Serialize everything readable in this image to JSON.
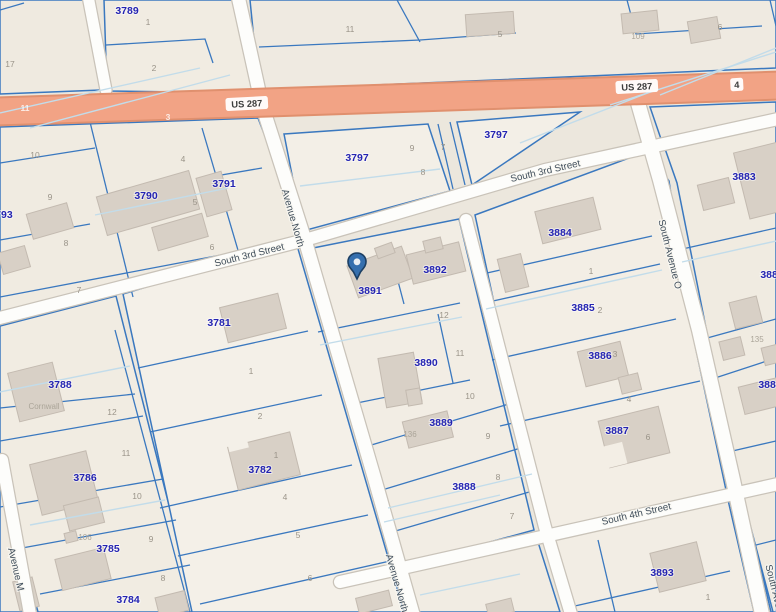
{
  "map": {
    "type": "parcel-gis-map",
    "colors": {
      "background": "#ece7dd",
      "parcel_line_blue": "#3a78bf",
      "parcel_number_navy": "#2424b2",
      "lot_number_gray": "#9a9489",
      "street_label": "#414f5c",
      "highway_fill": "#f2a385",
      "highway_edge": "#e0906e",
      "road_fill": "#fdfdfb",
      "building_fill": "#d8d0c6",
      "pin_fill": "#356fae",
      "pin_outline": "#1c3f63",
      "halflot_line_cyan": "#c2dcea"
    },
    "pin": {
      "name": "selected-location",
      "x": 357,
      "y": 279,
      "parcel": "3891"
    }
  },
  "street_labels": [
    {
      "text": "US 287",
      "x": 247,
      "y": 107,
      "rot": -3,
      "badge": true
    },
    {
      "text": "US 287",
      "x": 637,
      "y": 90,
      "rot": -3,
      "badge": true
    },
    {
      "text": "4",
      "x": 737,
      "y": 88,
      "rot": -3,
      "badge": true
    },
    {
      "text": "South 3rd Street",
      "x": 250,
      "y": 258,
      "rot": -14
    },
    {
      "text": "South 3rd Street",
      "x": 546,
      "y": 174,
      "rot": -13
    },
    {
      "text": "South 4th Street",
      "x": 637,
      "y": 517,
      "rot": -13
    },
    {
      "text": "Avenue North",
      "x": 290,
      "y": 219,
      "rot": 74
    },
    {
      "text": "Avenue North",
      "x": 394,
      "y": 584,
      "rot": 74
    },
    {
      "text": "South Avenue O",
      "x": 667,
      "y": 255,
      "rot": 76
    },
    {
      "text": "South Avenue O",
      "x": 774,
      "y": 600,
      "rot": 76
    },
    {
      "text": "Avenue M",
      "x": 13,
      "y": 570,
      "rot": 77
    }
  ],
  "parcel_labels": [
    {
      "text": "3789",
      "x": 127,
      "y": 14
    },
    {
      "text": "3790",
      "x": 146,
      "y": 199
    },
    {
      "text": "3791",
      "x": 224,
      "y": 187
    },
    {
      "text": "3793",
      "x": 1,
      "y": 218
    },
    {
      "text": "3797",
      "x": 357,
      "y": 161
    },
    {
      "text": "3797",
      "x": 496,
      "y": 138
    },
    {
      "text": "3883",
      "x": 744,
      "y": 180
    },
    {
      "text": "3884",
      "x": 560,
      "y": 236
    },
    {
      "text": "3885",
      "x": 583,
      "y": 311
    },
    {
      "text": "3885",
      "x": 772,
      "y": 278
    },
    {
      "text": "3886",
      "x": 600,
      "y": 359
    },
    {
      "text": "3887",
      "x": 617,
      "y": 434
    },
    {
      "text": "3888",
      "x": 464,
      "y": 490
    },
    {
      "text": "3889",
      "x": 441,
      "y": 426
    },
    {
      "text": "3890",
      "x": 426,
      "y": 366
    },
    {
      "text": "3891",
      "x": 370,
      "y": 294
    },
    {
      "text": "3892",
      "x": 435,
      "y": 273
    },
    {
      "text": "3893",
      "x": 662,
      "y": 576
    },
    {
      "text": "3880",
      "x": 770,
      "y": 388
    },
    {
      "text": "3781",
      "x": 219,
      "y": 326
    },
    {
      "text": "3782",
      "x": 260,
      "y": 473
    },
    {
      "text": "3788",
      "x": 60,
      "y": 388
    },
    {
      "text": "3786",
      "x": 85,
      "y": 481
    },
    {
      "text": "3785",
      "x": 108,
      "y": 552
    },
    {
      "text": "3784",
      "x": 128,
      "y": 603
    }
  ],
  "lot_labels": [
    {
      "text": "17",
      "x": 10,
      "y": 67
    },
    {
      "text": "1",
      "x": 148,
      "y": 25
    },
    {
      "text": "2",
      "x": 154,
      "y": 71
    },
    {
      "text": "11",
      "x": 350,
      "y": 32
    },
    {
      "text": "5",
      "x": 500,
      "y": 37
    },
    {
      "text": "6",
      "x": 720,
      "y": 30
    },
    {
      "text": "10",
      "x": 35,
      "y": 158
    },
    {
      "text": "9",
      "x": 50,
      "y": 200
    },
    {
      "text": "8",
      "x": 66,
      "y": 246
    },
    {
      "text": "7",
      "x": 79,
      "y": 293
    },
    {
      "text": "4",
      "x": 183,
      "y": 162
    },
    {
      "text": "5",
      "x": 195,
      "y": 205
    },
    {
      "text": "6",
      "x": 212,
      "y": 250
    },
    {
      "text": "9",
      "x": 412,
      "y": 151
    },
    {
      "text": "7",
      "x": 443,
      "y": 150
    },
    {
      "text": "8",
      "x": 423,
      "y": 175
    },
    {
      "text": "1",
      "x": 591,
      "y": 274
    },
    {
      "text": "2",
      "x": 600,
      "y": 313
    },
    {
      "text": "3",
      "x": 615,
      "y": 357
    },
    {
      "text": "4",
      "x": 629,
      "y": 402
    },
    {
      "text": "6",
      "x": 648,
      "y": 440
    },
    {
      "text": "12",
      "x": 444,
      "y": 318
    },
    {
      "text": "11",
      "x": 460,
      "y": 356
    },
    {
      "text": "10",
      "x": 470,
      "y": 399
    },
    {
      "text": "9",
      "x": 488,
      "y": 439
    },
    {
      "text": "8",
      "x": 498,
      "y": 480
    },
    {
      "text": "7",
      "x": 512,
      "y": 519
    },
    {
      "text": "12",
      "x": 112,
      "y": 415
    },
    {
      "text": "11",
      "x": 126,
      "y": 456
    },
    {
      "text": "10",
      "x": 137,
      "y": 499
    },
    {
      "text": "9",
      "x": 151,
      "y": 542
    },
    {
      "text": "8",
      "x": 163,
      "y": 581
    },
    {
      "text": "1",
      "x": 251,
      "y": 374
    },
    {
      "text": "2",
      "x": 260,
      "y": 419
    },
    {
      "text": "1",
      "x": 276,
      "y": 458
    },
    {
      "text": "4",
      "x": 285,
      "y": 500
    },
    {
      "text": "5",
      "x": 298,
      "y": 538
    },
    {
      "text": "6",
      "x": 310,
      "y": 581
    },
    {
      "text": "1",
      "x": 708,
      "y": 600
    }
  ],
  "house_labels": [
    {
      "text": "109",
      "x": 638,
      "y": 39
    },
    {
      "text": "106",
      "x": 85,
      "y": 540
    },
    {
      "text": "135",
      "x": 757,
      "y": 342
    },
    {
      "text": "136",
      "x": 410,
      "y": 437
    },
    {
      "text": "Cornwall",
      "x": 44,
      "y": 409
    }
  ],
  "band_labels": [
    {
      "text": "11",
      "x": 25,
      "y": 111
    },
    {
      "text": "3",
      "x": 168,
      "y": 120
    }
  ]
}
